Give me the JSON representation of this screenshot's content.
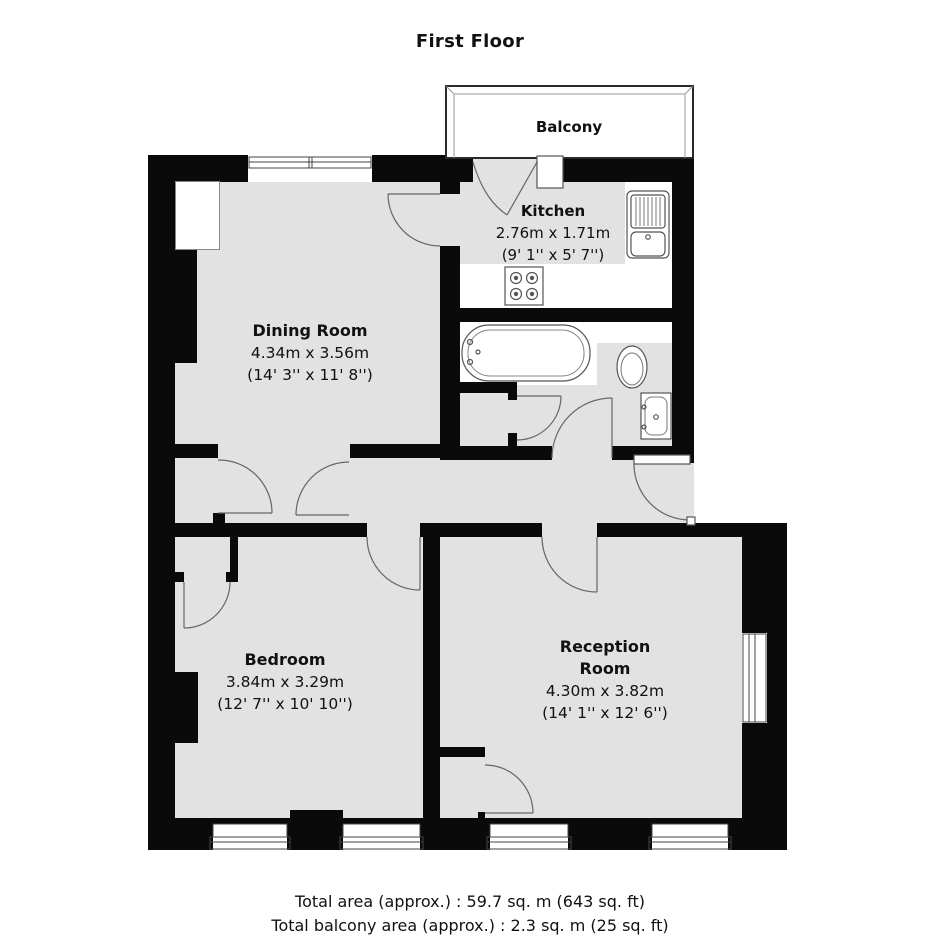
{
  "title": "First Floor",
  "balcony": {
    "label": "Balcony"
  },
  "rooms": {
    "kitchen": {
      "name": "Kitchen",
      "metric": "2.76m x 1.71m",
      "imperial": "(9' 1'' x 5' 7'')"
    },
    "dining": {
      "name": "Dining Room",
      "metric": "4.34m x 3.56m",
      "imperial": "(14' 3'' x 11' 8'')"
    },
    "bedroom": {
      "name": "Bedroom",
      "metric": "3.84m x 3.29m",
      "imperial": "(12' 7'' x 10' 10'')"
    },
    "reception": {
      "name": "Reception Room",
      "metric": "4.30m x 3.82m",
      "imperial": "(14' 1'' x 12' 6'')"
    }
  },
  "footer": {
    "total_area": "Total area (approx.) : 59.7 sq. m (643 sq. ft)",
    "total_balcony_area": "Total balcony area (approx.) : 2.3 sq. m (25 sq. ft)"
  },
  "fixtures": [
    "bathtub",
    "toilet",
    "wash-basin",
    "kitchen-sink",
    "hob"
  ],
  "colors": {
    "wall": "#0a0a0a",
    "floor": "#e2e2e2",
    "line": "#555555",
    "background": "#ffffff"
  }
}
